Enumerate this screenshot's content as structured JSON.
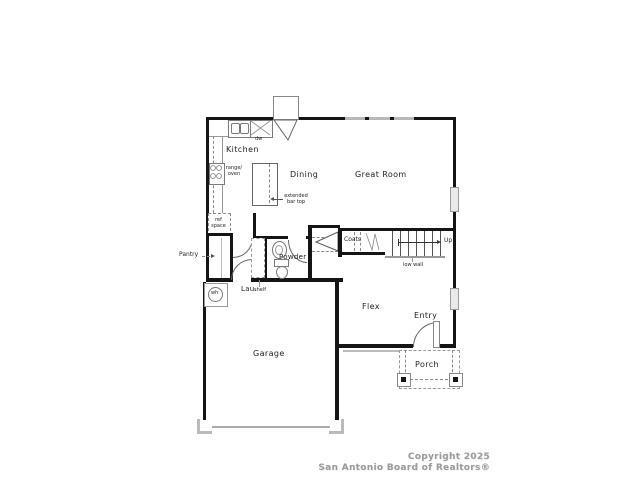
{
  "floorplan": {
    "rooms": {
      "kitchen": "Kitchen",
      "dining": "Dining",
      "great_room": "Great Room",
      "powder": "Powder",
      "laundry": "Lau.",
      "pantry": "Pantry",
      "coats": "Coats",
      "flex": "Flex",
      "entry": "Entry",
      "porch": "Porch",
      "garage": "Garage"
    },
    "annotations": {
      "up": "Up",
      "low_wall": "low wall",
      "shelf": "shelf",
      "ref_space": "ref space",
      "range_oven": "range/ oven",
      "extended_bar_top": "extended bar top",
      "dishwasher": "dw",
      "water_heater": "wh"
    },
    "colors": {
      "wall": "#151515",
      "thin_line": "#999999",
      "window": "#b8b8b8",
      "label_text": "#222222",
      "footer_text": "#9b9b9b"
    }
  },
  "footer": {
    "copyright": "Copyright 2025",
    "organization": "San Antonio Board of Realtors®"
  }
}
